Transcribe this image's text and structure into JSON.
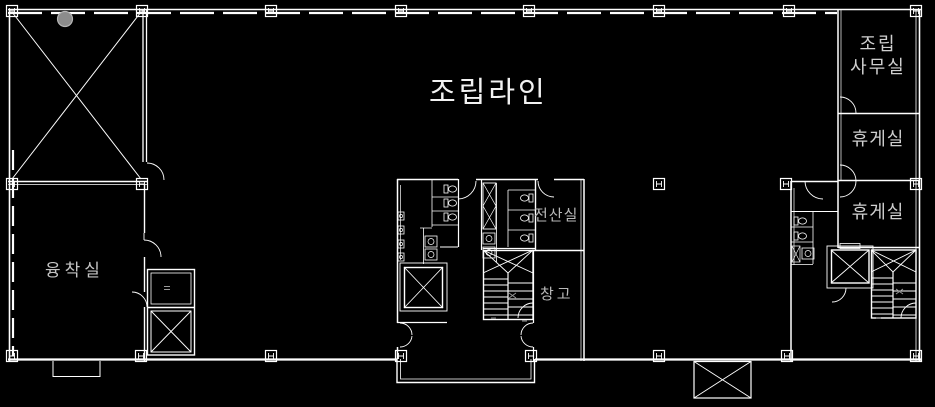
{
  "colors": {
    "background": "#000000",
    "wall_line": "#ffffff",
    "room_label_text": "#c9c9c9",
    "title_text": "#f2f2f2",
    "gray_dot_marker": "#8c8c8c"
  },
  "labels": {
    "assembly_line": "조립라인",
    "assembly_office": "조립\n사무실",
    "lounge_upper": "휴게실",
    "lounge_lower": "휴게실",
    "fusion_room": "융착실",
    "computer_room": "전산실",
    "storage_room": "창고"
  }
}
